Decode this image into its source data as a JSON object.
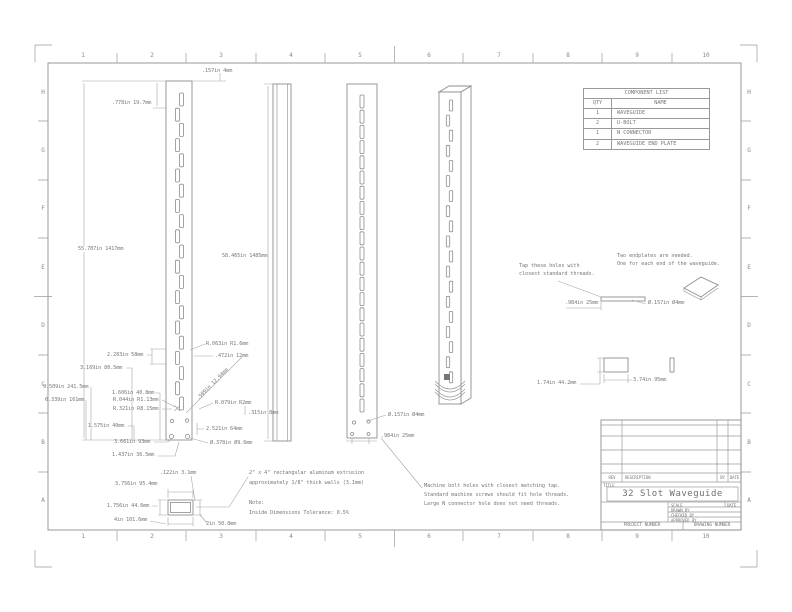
{
  "sheet": {
    "zones_top": [
      "1",
      "2",
      "3",
      "4",
      "5",
      "6",
      "7",
      "8",
      "9",
      "10"
    ],
    "zones_left": [
      "H",
      "G",
      "F",
      "E",
      "D",
      "C",
      "B",
      "A"
    ]
  },
  "colors": {
    "ink": "#8d8d8d",
    "text": "#787878",
    "paper": "#ffffff"
  },
  "component_list": {
    "title": "COMPONENT LIST",
    "headers": {
      "qty": "QTY",
      "name": "NAME"
    },
    "rows": [
      {
        "qty": "1",
        "name": "WAVEGUIDE"
      },
      {
        "qty": "2",
        "name": "U-BOLT"
      },
      {
        "qty": "1",
        "name": "N CONNECTOR"
      },
      {
        "qty": "2",
        "name": "WAVEGUIDE END PLATE"
      }
    ]
  },
  "title_block": {
    "rev_label": "REV",
    "description_label": "DESCRIPTION",
    "by_label": "BY",
    "date_label": "DATE",
    "title_label": "TITLE",
    "title": "32 Slot Waveguide",
    "scale_label": "SCALE",
    "drawn_by_label": "DRAWN BY",
    "checked_by_label": "CHECKED BY",
    "approved_by_label": "APPROVED BY",
    "project_number_label": "PROJECT NUMBER",
    "drawing_number_label": "DRAWING NUMBER"
  },
  "dims": {
    "top_offset": ".157in 4mm",
    "first_slot": ".778in 19.7mm",
    "body_length": "55.787in 1417mm",
    "overall_length": "58.465in 1485mm",
    "slot_corner_radius": "R.063in R1.6mm",
    "slot_pitch": "2.283in 58mm",
    "slot_length": ".472in 12mm",
    "offset_3169": "3.169in 80.5mm",
    "offset_9509": "9.509in 241.5mm",
    "offset_1606": "1.606in 40.8mm",
    "offset_6339": "6.339in 161mm",
    "radius_044": "R.044in R1.13mm",
    "radius_321": "R.321in R8.15mm",
    "diag_509": ".509in 12.94mm",
    "radius_079": "R.079in R2mm",
    "offset_315": ".315in 8mm",
    "offset_1575": "1.575in 40mm",
    "offset_2521": "2.521in 64mm",
    "offset_3661": "3.661in 93mm",
    "offset_1437": "1.437in 36.5mm",
    "hole_dia_378": "Ø.378in Ø9.6mm",
    "rear_hole_dia": "Ø.157in Ø4mm",
    "rear_hole_spacing": ".984in 25mm",
    "endplate_hole_dia": "Ø.157in Ø4mm",
    "endplate_hole_spacing": ".984in 25mm",
    "endplate_height": "1.74in 44.2mm",
    "endplate_width": "3.74in 95mm",
    "wall_thickness": ".122in 3.1mm",
    "inner_width": "3.756in 95.4mm",
    "inner_height": "1.756in 44.6mm",
    "outer_width": "4in 101.6mm",
    "outer_height": "2in 50.8mm"
  },
  "notes": {
    "tap_holes": [
      "Tap these holes with",
      "closest standard threads."
    ],
    "endplates": [
      "Two endplates are needed.",
      "One for each end of the waveguide."
    ],
    "machine_bolts": [
      "Machine bolt holes with closest matching tap.",
      "Standard machine screws should fit hole threads.",
      "Large N connector hole does not need threads."
    ],
    "extrusion": [
      "2\" x 4\" rectangular aluminum extrusion",
      "approximately 1/8\" thick walls (3.1mm)"
    ],
    "note_label": "Note:",
    "tolerance": "Inside Dimensions Tolerance: 0.5%"
  }
}
